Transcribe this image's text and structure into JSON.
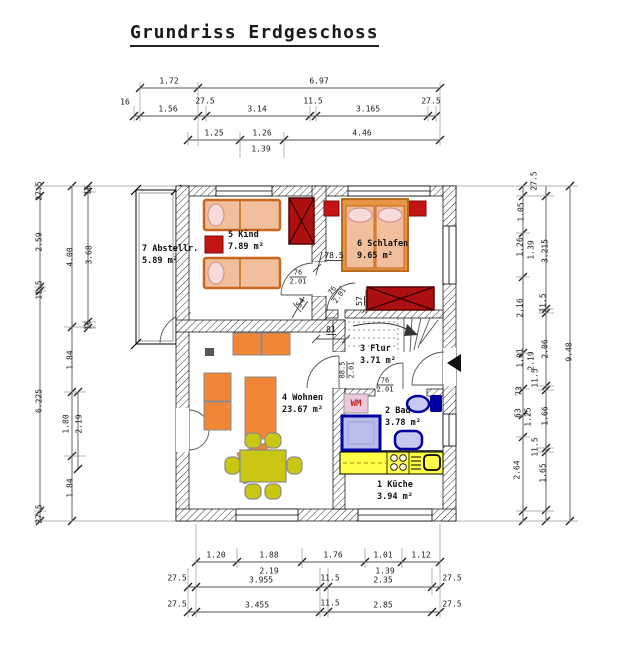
{
  "title": "Grundriss Erdgeschoss",
  "rooms": [
    {
      "name": "5 Kind",
      "area": "7.89 m²",
      "x": 228,
      "y": 229
    },
    {
      "name": "6 Schlafen",
      "area": "9.65 m²",
      "x": 357,
      "y": 238
    },
    {
      "name": "7 Abstellr.",
      "area": "5.89 m²",
      "x": 142,
      "y": 243
    },
    {
      "name": "3 Flur",
      "area": "3.71 m²",
      "x": 360,
      "y": 343
    },
    {
      "name": "4 Wohnen",
      "area": "23.67 m²",
      "x": 282,
      "y": 392
    },
    {
      "name": "2 Bad",
      "area": "3.78 m²",
      "x": 385,
      "y": 405
    },
    {
      "name": "1 Küche",
      "area": "3.94 m²",
      "x": 377,
      "y": 479
    }
  ],
  "appliance_labels": [
    {
      "t": "WM",
      "x": 356,
      "y": 404
    }
  ],
  "door_dims": [
    {
      "top": "76",
      "bottom": "2.01",
      "x": 298,
      "y": 277,
      "rot": 0
    },
    {
      "top": "76",
      "bottom": "2.01",
      "x": 336,
      "y": 293,
      "rot": -55
    },
    {
      "top": "88.5",
      "bottom": "2.01",
      "x": 347,
      "y": 370,
      "rot": -90
    },
    {
      "top": "76",
      "bottom": "2.01",
      "x": 385,
      "y": 385,
      "rot": 0
    }
  ],
  "interior_dims": [
    {
      "t": "78.5",
      "x": 334,
      "y": 256,
      "rot": 0
    },
    {
      "t": "54",
      "x": 301,
      "y": 303,
      "rot": -55
    },
    {
      "t": "57",
      "x": 360,
      "y": 301,
      "rot": -90
    },
    {
      "t": "81",
      "x": 331,
      "y": 330,
      "rot": 0
    }
  ],
  "dim_chains": {
    "top": [
      {
        "t": "1.72",
        "x": 169,
        "y": 81
      },
      {
        "t": "6.97",
        "x": 319,
        "y": 81
      },
      {
        "t": "16",
        "x": 125,
        "y": 102
      },
      {
        "t": "1.56",
        "x": 168,
        "y": 109
      },
      {
        "t": "27.5",
        "x": 205,
        "y": 101
      },
      {
        "t": "3.14",
        "x": 257,
        "y": 109
      },
      {
        "t": "11.5",
        "x": 313,
        "y": 101
      },
      {
        "t": "3.165",
        "x": 368,
        "y": 109
      },
      {
        "t": "27.5",
        "x": 431,
        "y": 101
      },
      {
        "t": "1.25",
        "x": 214,
        "y": 133
      },
      {
        "t": "1.26",
        "x": 262,
        "y": 133
      },
      {
        "t": "4.46",
        "x": 362,
        "y": 133
      },
      {
        "t": "1.39",
        "x": 261,
        "y": 149
      }
    ],
    "bottom": [
      {
        "t": "1.20",
        "x": 216,
        "y": 555
      },
      {
        "t": "1.88",
        "x": 269,
        "y": 555
      },
      {
        "t": "1.76",
        "x": 333,
        "y": 555
      },
      {
        "t": "1.01",
        "x": 383,
        "y": 555
      },
      {
        "t": "1.12",
        "x": 421,
        "y": 555
      },
      {
        "t": "2.19",
        "x": 269,
        "y": 571
      },
      {
        "t": "1.39",
        "x": 385,
        "y": 571
      },
      {
        "t": "27.5",
        "x": 177,
        "y": 578
      },
      {
        "t": "3.955",
        "x": 261,
        "y": 580
      },
      {
        "t": "11.5",
        "x": 330,
        "y": 578
      },
      {
        "t": "2.35",
        "x": 383,
        "y": 580
      },
      {
        "t": "27.5",
        "x": 452,
        "y": 578
      },
      {
        "t": "27.5",
        "x": 177,
        "y": 604
      },
      {
        "t": "3.455",
        "x": 257,
        "y": 605
      },
      {
        "t": "11.5",
        "x": 330,
        "y": 603
      },
      {
        "t": "2.85",
        "x": 383,
        "y": 605
      },
      {
        "t": "27.5",
        "x": 452,
        "y": 604
      }
    ],
    "left": [
      {
        "t": "27.5",
        "x": 39,
        "y": 191,
        "rot": -90
      },
      {
        "t": "2.59",
        "x": 39,
        "y": 242,
        "rot": -90
      },
      {
        "t": "11.5",
        "x": 39,
        "y": 290,
        "rot": -90
      },
      {
        "t": "6.225",
        "x": 39,
        "y": 401,
        "rot": -90
      },
      {
        "t": "27.5",
        "x": 39,
        "y": 514,
        "rot": -90
      },
      {
        "t": "4.00",
        "x": 70,
        "y": 257,
        "rot": -90
      },
      {
        "t": "1.84",
        "x": 70,
        "y": 360,
        "rot": -90
      },
      {
        "t": "1.80",
        "x": 66,
        "y": 424,
        "rot": -90
      },
      {
        "t": "2.19",
        "x": 79,
        "y": 424,
        "rot": -90
      },
      {
        "t": "1.84",
        "x": 70,
        "y": 488,
        "rot": -90
      },
      {
        "t": "16",
        "x": 88,
        "y": 190,
        "rot": -90
      },
      {
        "t": "3.68",
        "x": 89,
        "y": 255,
        "rot": -90
      },
      {
        "t": "16",
        "x": 88,
        "y": 325,
        "rot": -90
      }
    ],
    "right": [
      {
        "t": "27.5",
        "x": 534,
        "y": 181,
        "rot": -90
      },
      {
        "t": "1.05",
        "x": 521,
        "y": 212,
        "rot": -90
      },
      {
        "t": "1.26",
        "x": 520,
        "y": 247,
        "rot": -90
      },
      {
        "t": "1.39",
        "x": 531,
        "y": 250,
        "rot": -90
      },
      {
        "t": "2.16",
        "x": 520,
        "y": 308,
        "rot": -90
      },
      {
        "t": "1.01",
        "x": 520,
        "y": 358,
        "rot": -90
      },
      {
        "t": "2.19",
        "x": 531,
        "y": 361,
        "rot": -90
      },
      {
        "t": "73",
        "x": 519,
        "y": 391,
        "rot": -90
      },
      {
        "t": "63",
        "x": 518,
        "y": 413,
        "rot": -90
      },
      {
        "t": "1.25",
        "x": 528,
        "y": 417,
        "rot": -90
      },
      {
        "t": "2.64",
        "x": 517,
        "y": 470,
        "rot": -90
      },
      {
        "t": "3.215",
        "x": 545,
        "y": 251,
        "rot": -90
      },
      {
        "t": "11.5",
        "x": 543,
        "y": 303,
        "rot": -90
      },
      {
        "t": "2.06",
        "x": 545,
        "y": 349,
        "rot": -90
      },
      {
        "t": "11.5",
        "x": 535,
        "y": 378,
        "rot": -90
      },
      {
        "t": "1.66",
        "x": 545,
        "y": 416,
        "rot": -90
      },
      {
        "t": "11.5",
        "x": 535,
        "y": 447,
        "rot": -90
      },
      {
        "t": "1.65",
        "x": 543,
        "y": 473,
        "rot": -90
      },
      {
        "t": "9.48",
        "x": 569,
        "y": 352,
        "rot": -90
      }
    ]
  },
  "colors": {
    "furniture_orange": "#f08636",
    "bed_peach": "#f2bf9d",
    "red_items": "#c41414",
    "wardrobe_red": "#ad1010",
    "dining_olive": "#c9c714",
    "kitchen_yellow": "#ffff47",
    "bath_blue": "#0000a0",
    "shower_fill": "#b9bde9",
    "wm_pink": "#ecc9da",
    "wm_text": "#cc2222"
  }
}
